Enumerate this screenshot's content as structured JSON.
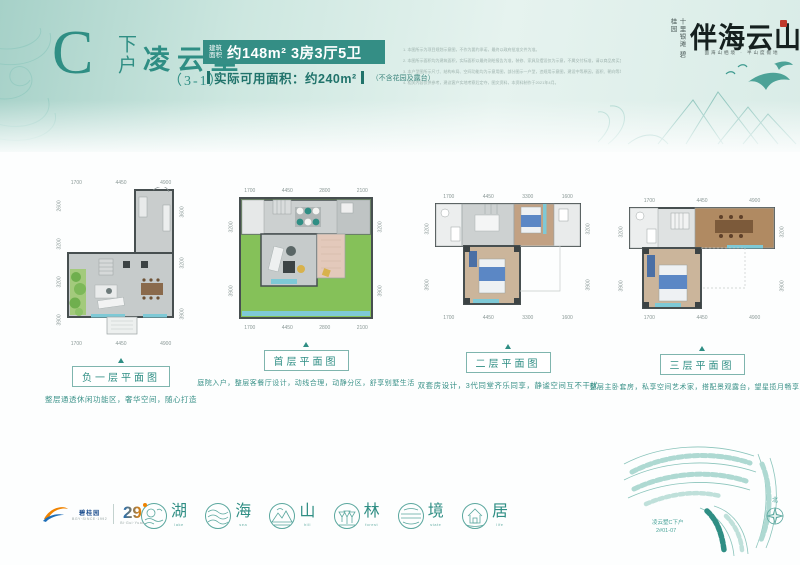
{
  "header": {
    "unit_letter": "C",
    "unit_suffix": "下户",
    "name": "凌云墅",
    "name_sub": "（3-1）",
    "area_label": "建筑\n面积",
    "area_label_l1": "建筑",
    "area_label_l2": "面积",
    "area_value": "约148m² 3房3厅5卫",
    "usable_text": "实际可用面积：约240m²",
    "usable_note": "（不含花园及露台）",
    "disclaimers": [
      "1. 本图所示为项目规划示意图，不作为要约承诺，最终以政府批准文件为准。",
      "2. 本图所示面积均为建筑面积，实际面积以最终测绘报告为准，装修、家具及摆设仅为示意，不属交付标准，请以商品房买卖合同约定为准。",
      "3. 本户型图所示尺寸、结构布局、空间功能均为示意用图，部分图示一户型，违规用示意图，建设中等原因，面积、朝向等均有变更，最终以实际交付为准。",
      "4. 相关内容仅供参考，建议客户实地考察后定夺，图文资料，本资料制作于2021年4月。"
    ]
  },
  "brand": {
    "vertical_text_right": "十里银滩",
    "vertical_text_left": "碧桂园",
    "logo": "伴海云山",
    "tagline": "面海山栖境 · 半山度假地"
  },
  "plans": [
    {
      "label": "负一层平面图",
      "caption": "整层通透休闲功能区，奢华空间，随心打造",
      "dims_top": [
        "1700",
        "4450",
        "4900"
      ],
      "dims_bottom": [
        "1700",
        "4450",
        "4900"
      ],
      "dims_left": [
        "2600",
        "3200",
        "3200",
        "3900"
      ],
      "dims_right": [
        "3600",
        "3200",
        "3900"
      ]
    },
    {
      "label": "首层平面图",
      "caption": "庭院入户，整层客餐厅设计，动线合理，动静分区，舒享别墅生活",
      "dims_top": [
        "1700",
        "4450",
        "2800",
        "2100"
      ],
      "dims_bottom": [
        "1700",
        "4450",
        "2800",
        "2100"
      ],
      "dims_left": [
        "3200",
        "3900"
      ],
      "dims_right": [
        "3200",
        "3900"
      ]
    },
    {
      "label": "二层平面图",
      "caption": "双套房设计，3代同堂齐乐同享，静谧空间互不干扰",
      "dims_top": [
        "1700",
        "4450",
        "3300",
        "1600"
      ],
      "dims_bottom": [
        "1700",
        "4450",
        "3300",
        "1600"
      ],
      "dims_left": [
        "3200",
        "3900"
      ],
      "dims_right": [
        "3200",
        "3900"
      ]
    },
    {
      "label": "三层平面图",
      "caption": "整层主卧套房，私享空间艺术家，搭配景观露台，望星揽月畅享天地",
      "dims_top": [
        "1700",
        "4450",
        "4900"
      ],
      "dims_bottom": [
        "1700",
        "4450",
        "4900"
      ],
      "dims_left": [
        "3200",
        "3900"
      ],
      "dims_right": [
        "3200",
        "3900"
      ]
    }
  ],
  "features": [
    {
      "char": "湖",
      "en": "lake"
    },
    {
      "char": "海",
      "en": "sea"
    },
    {
      "char": "山",
      "en": "hill"
    },
    {
      "char": "林",
      "en": "forest"
    },
    {
      "char": "境",
      "en": "state"
    },
    {
      "char": "居",
      "en": "life"
    }
  ],
  "footer": {
    "developer": "碧桂园",
    "developer_sub": "BGY·SINCE·1992",
    "anniversary": "29",
    "anniversary_sub": "Bi·Gui·Yuan"
  },
  "siteplan": {
    "label_line1": "凌云墅C下户",
    "label_line2": "2#01-07",
    "north": "北"
  },
  "colors": {
    "accent": "#2f8e84",
    "area_box_bg": "#348e85",
    "garden_green": "#85c159",
    "wood": "#c2a183",
    "plan_grey": "#c9cdcd",
    "window_teal": "#7ec9d6",
    "logo_black": "#15201f",
    "seal_red": "#c0392b"
  }
}
